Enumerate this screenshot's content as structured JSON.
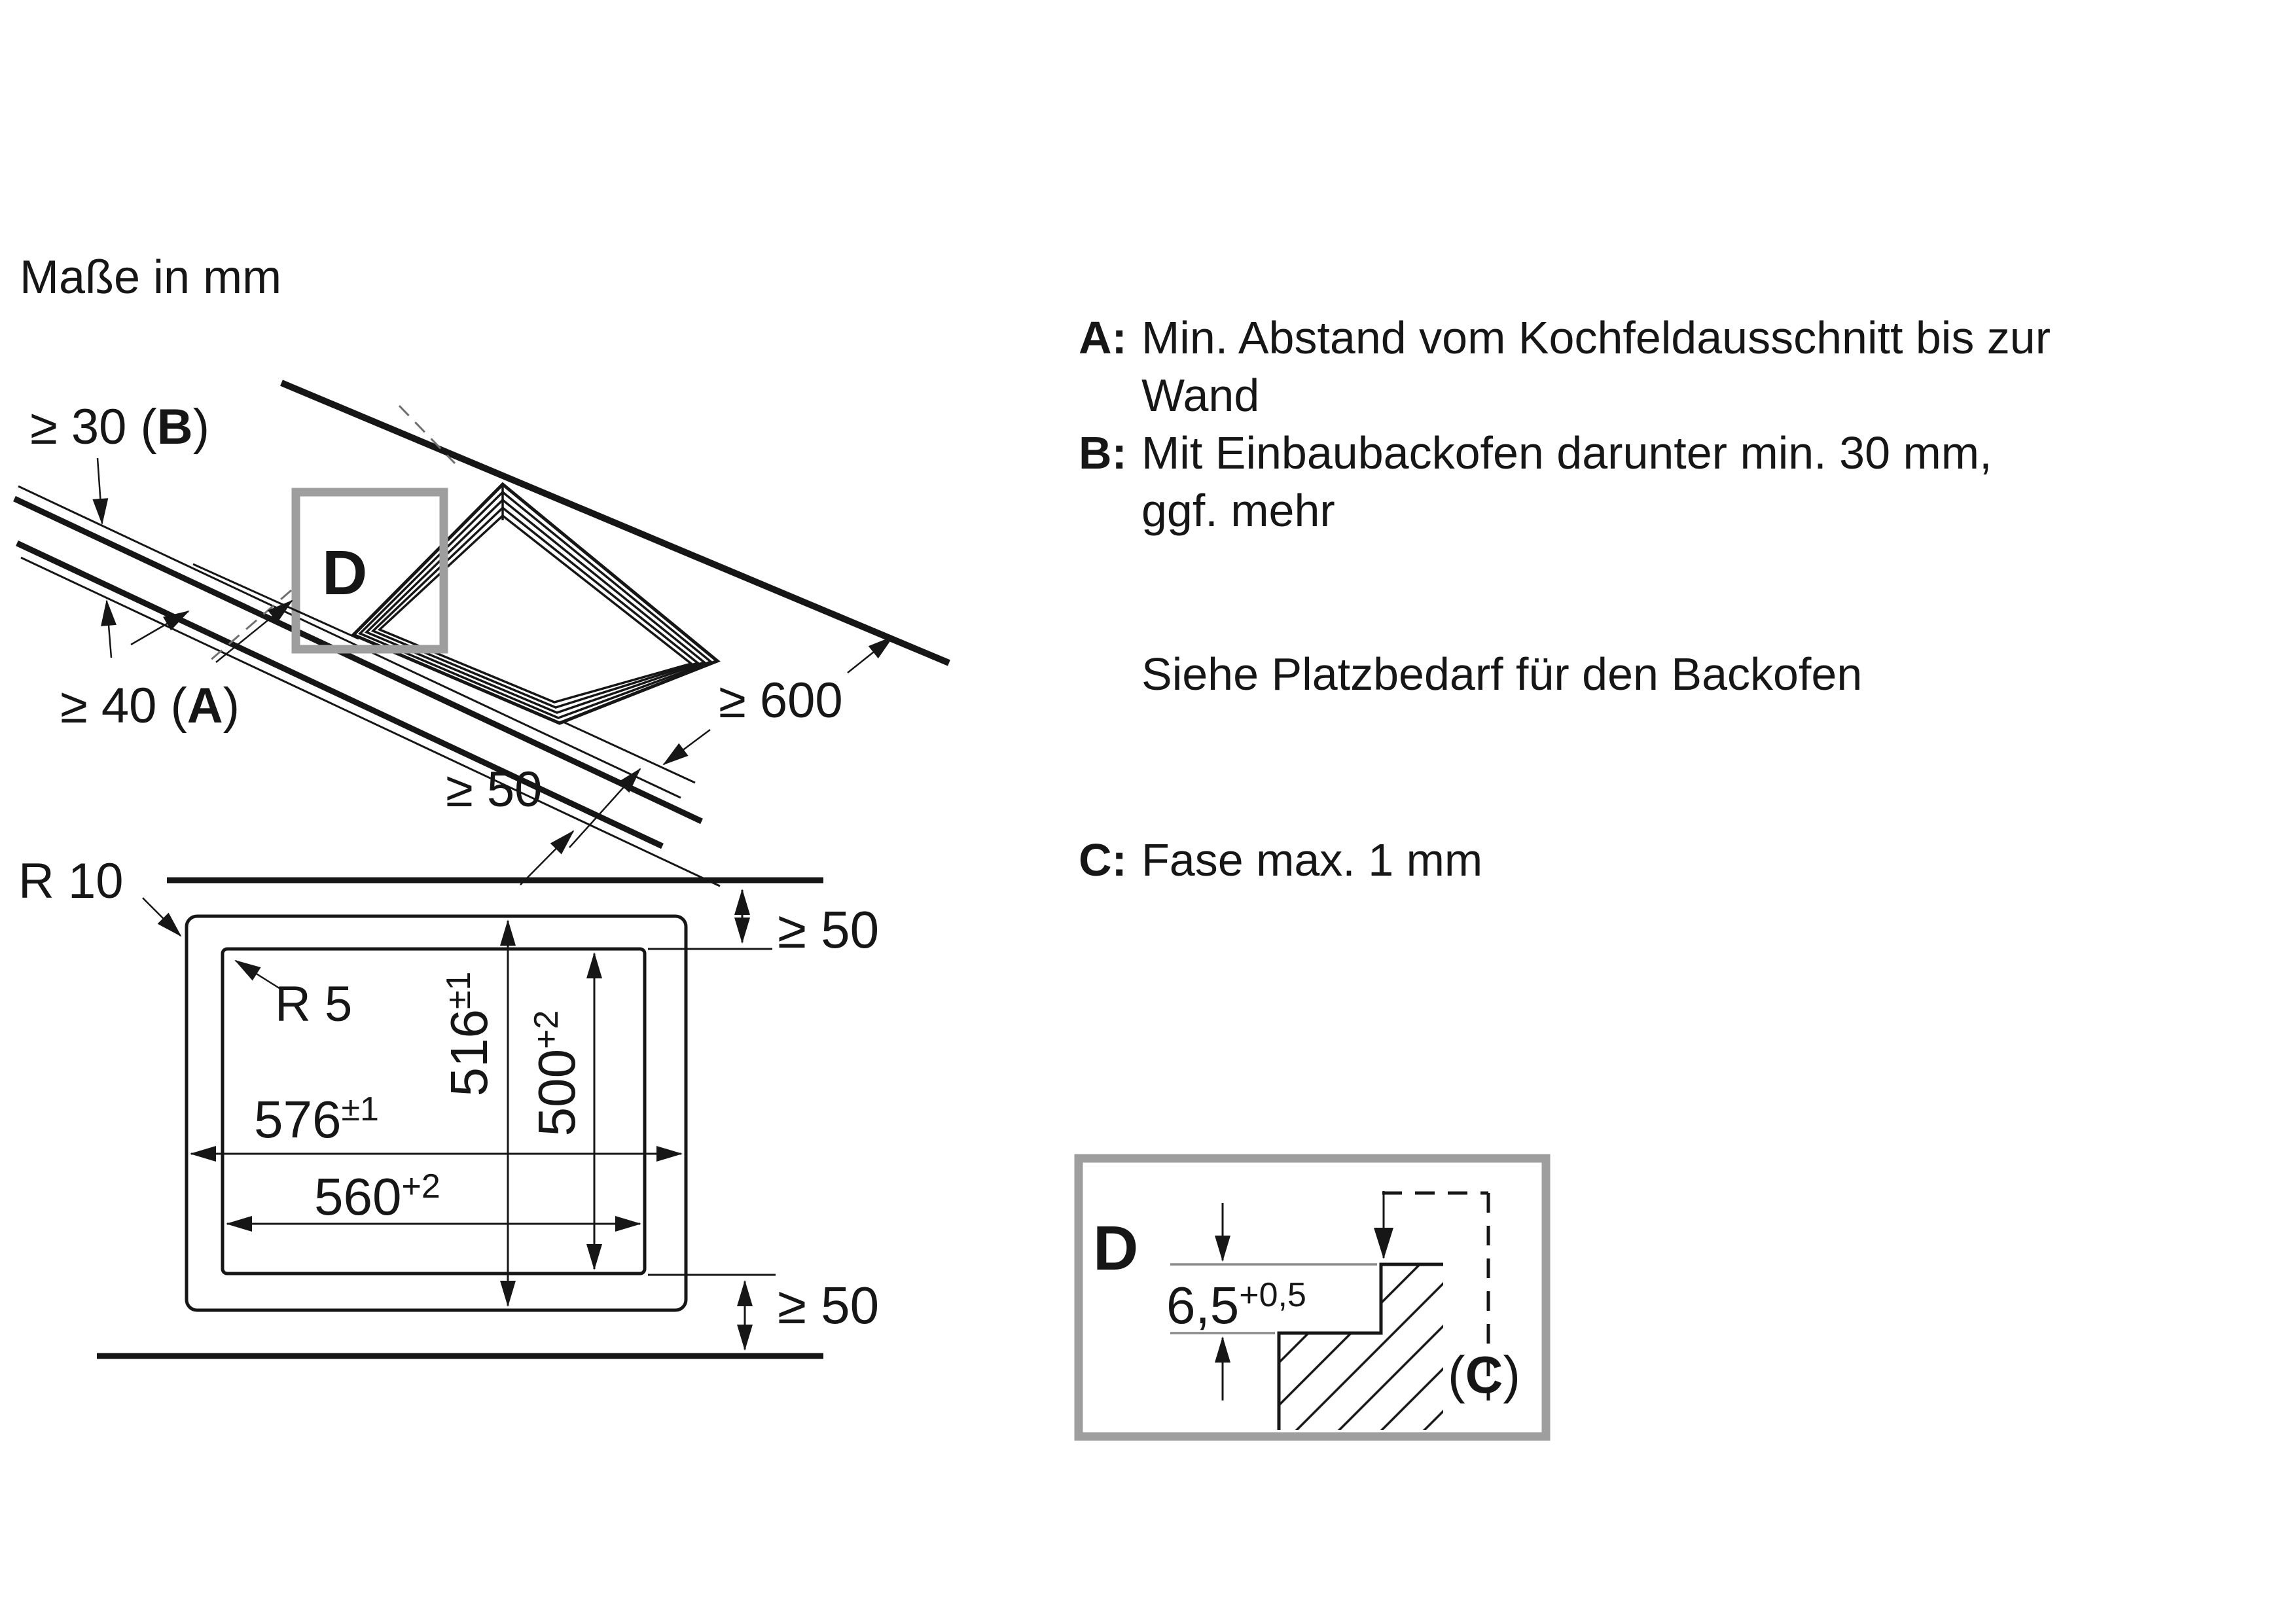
{
  "title": "Maße in mm",
  "iso": {
    "thickness_label": {
      "pre": "≥ 30 (",
      "bold": "B",
      "post": ")"
    },
    "wall_gap_label": {
      "pre": "≥ 40 (",
      "bold": "A",
      "post": ")"
    },
    "front_gap_label": "≥ 50",
    "worktop_depth_label": "≥ 600",
    "detail_marker": "D"
  },
  "plan": {
    "radius_outer": "R 10",
    "radius_inner": "R 5",
    "clearance_rear": "≥ 50",
    "clearance_front": "≥ 50",
    "hob_width": {
      "base": "576",
      "sup": "±1"
    },
    "hob_depth": {
      "base": "516",
      "sup": "±1"
    },
    "cutout_width": {
      "base": "560",
      "sup": "+2"
    },
    "cutout_depth": {
      "base": "500",
      "sup": "+2"
    }
  },
  "detail": {
    "marker": "D",
    "step_depth": {
      "base": "6,5",
      "sup": "+0,5"
    },
    "chamfer": {
      "pre": "(",
      "bold": "C",
      "post": ")"
    }
  },
  "notes": {
    "a_label": "A:",
    "a_lines": [
      "Min. Abstand vom Kochfeldausschnitt bis zur",
      "Wand"
    ],
    "b_label": "B:",
    "b_lines": [
      "Mit Einbaubackofen darunter min. 30 mm,",
      "ggf. mehr"
    ],
    "see_note": "Siehe Platzbedarf für den Backofen",
    "c_label": "C:",
    "c_text": "Fase max. 1 mm"
  },
  "colors": {
    "ink": "#161616",
    "frame_gray": "#9e9e9e",
    "dim_gray": "#8c8c8c",
    "background": "#ffffff"
  }
}
